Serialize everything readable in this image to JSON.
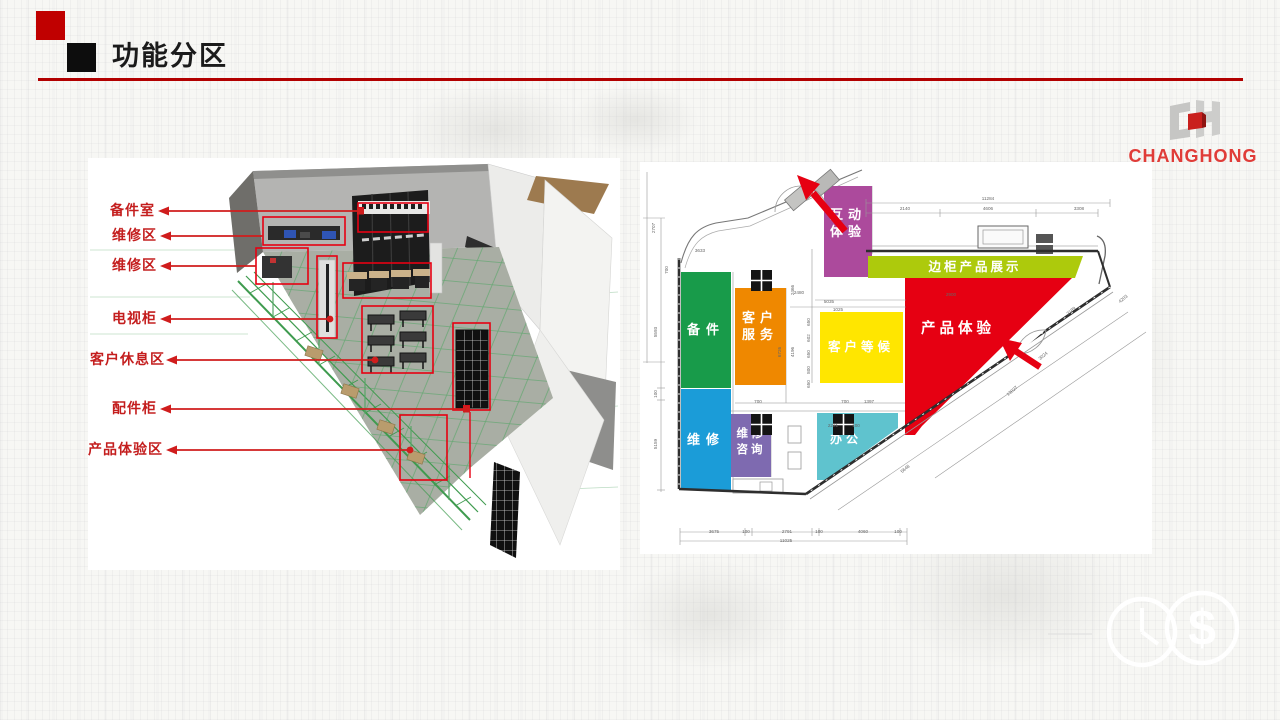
{
  "slide": {
    "title": "功能分区"
  },
  "logo": {
    "brand": "CHANGHONG"
  },
  "render_view": {
    "labels": [
      {
        "text": "备件室",
        "tx": 110,
        "ty": 211,
        "x1": 158,
        "x2": 360,
        "end": "rect"
      },
      {
        "text": "维修区",
        "tx": 112,
        "ty": 236,
        "x1": 160,
        "x2": 263,
        "end": "none"
      },
      {
        "text": "维修区",
        "tx": 112,
        "ty": 266,
        "x1": 160,
        "x2": 256,
        "end": "none"
      },
      {
        "text": "电视柜",
        "tx": 112,
        "ty": 319,
        "x1": 160,
        "x2": 330,
        "end": "dot"
      },
      {
        "text": "客户休息区",
        "tx": 90,
        "ty": 360,
        "x1": 166,
        "x2": 375,
        "end": "dot"
      },
      {
        "text": "配件柜",
        "tx": 112,
        "ty": 409,
        "x1": 160,
        "x2": 466,
        "end": "rect"
      },
      {
        "text": "产品体验区",
        "tx": 88,
        "ty": 450,
        "x1": 166,
        "x2": 410,
        "end": "dot"
      }
    ]
  },
  "floorplan": {
    "zones": [
      {
        "id": "hudong",
        "name": "互动体验",
        "lines": [
          "互动",
          "体验"
        ],
        "color": "#ac4a9c"
      },
      {
        "id": "biangui",
        "name": "边柜产品展示",
        "lines": [
          "边柜产品展示"
        ],
        "color": "#adca0c"
      },
      {
        "id": "beijian",
        "name": "备件",
        "lines": [
          "备件"
        ],
        "color": "#189b4a"
      },
      {
        "id": "kefu",
        "name": "客户服务",
        "lines": [
          "客户",
          "服务"
        ],
        "color": "#ef8800"
      },
      {
        "id": "denghou",
        "name": "客户等候",
        "lines": [
          "客户等候"
        ],
        "color": "#ffe600"
      },
      {
        "id": "chanpin",
        "name": "产品体验",
        "lines": [
          "产品体验"
        ],
        "color": "#e60012"
      },
      {
        "id": "weixiu",
        "name": "维修",
        "lines": [
          "维修"
        ],
        "color": "#1b9cd8"
      },
      {
        "id": "zixun",
        "name": "维修咨询",
        "lines": [
          "维修",
          "咨询"
        ],
        "color": "#7e6ab0"
      },
      {
        "id": "bangong",
        "name": "办公",
        "lines": [
          "办公"
        ],
        "color": "#5fc3ce"
      }
    ],
    "dims": [
      {
        "t": "11284",
        "x": 988,
        "y": 200
      },
      {
        "t": "2140",
        "x": 905,
        "y": 210
      },
      {
        "t": "4606",
        "x": 988,
        "y": 210
      },
      {
        "t": "3308",
        "x": 1079,
        "y": 210
      },
      {
        "t": "3633",
        "x": 700,
        "y": 252
      },
      {
        "t": "2707",
        "x": 655,
        "y": 228,
        "r": -90
      },
      {
        "t": "700",
        "x": 668,
        "y": 270,
        "r": -90
      },
      {
        "t": "5593",
        "x": 657,
        "y": 332,
        "r": -90
      },
      {
        "t": "100",
        "x": 657,
        "y": 394,
        "r": -90
      },
      {
        "t": "5159",
        "x": 657,
        "y": 444,
        "r": -90
      },
      {
        "t": "2480",
        "x": 799,
        "y": 294
      },
      {
        "t": "5035",
        "x": 829,
        "y": 303
      },
      {
        "t": "2900",
        "x": 951,
        "y": 296
      },
      {
        "t": "1025",
        "x": 838,
        "y": 311
      },
      {
        "t": "2466",
        "x": 794,
        "y": 290,
        "r": -90
      },
      {
        "t": "4196",
        "x": 794,
        "y": 352,
        "r": -90
      },
      {
        "t": "6726",
        "x": 781,
        "y": 352,
        "r": -90
      },
      {
        "t": "650",
        "x": 810,
        "y": 322,
        "r": -90
      },
      {
        "t": "602",
        "x": 810,
        "y": 338,
        "r": -90
      },
      {
        "t": "650",
        "x": 810,
        "y": 354,
        "r": -90
      },
      {
        "t": "800",
        "x": 810,
        "y": 370,
        "r": -90
      },
      {
        "t": "650",
        "x": 810,
        "y": 384,
        "r": -90
      },
      {
        "t": "700",
        "x": 758,
        "y": 403
      },
      {
        "t": "700",
        "x": 845,
        "y": 403
      },
      {
        "t": "1397",
        "x": 869,
        "y": 403
      },
      {
        "t": "2221",
        "x": 833,
        "y": 427
      },
      {
        "t": "100",
        "x": 856,
        "y": 427
      },
      {
        "t": "3675",
        "x": 714,
        "y": 533
      },
      {
        "t": "100",
        "x": 746,
        "y": 533
      },
      {
        "t": "2791",
        "x": 787,
        "y": 533
      },
      {
        "t": "100",
        "x": 819,
        "y": 533
      },
      {
        "t": "4060",
        "x": 863,
        "y": 533
      },
      {
        "t": "100",
        "x": 898,
        "y": 533
      },
      {
        "t": "11025",
        "x": 786,
        "y": 542
      },
      {
        "t": "2189",
        "x": 1072,
        "y": 312,
        "r": -40
      },
      {
        "t": "3024",
        "x": 1044,
        "y": 357,
        "r": -40
      },
      {
        "t": "13027",
        "x": 1013,
        "y": 392,
        "r": -40
      },
      {
        "t": "5648",
        "x": 906,
        "y": 470,
        "r": -40
      },
      {
        "t": "4203",
        "x": 1124,
        "y": 300,
        "r": -40
      }
    ]
  }
}
